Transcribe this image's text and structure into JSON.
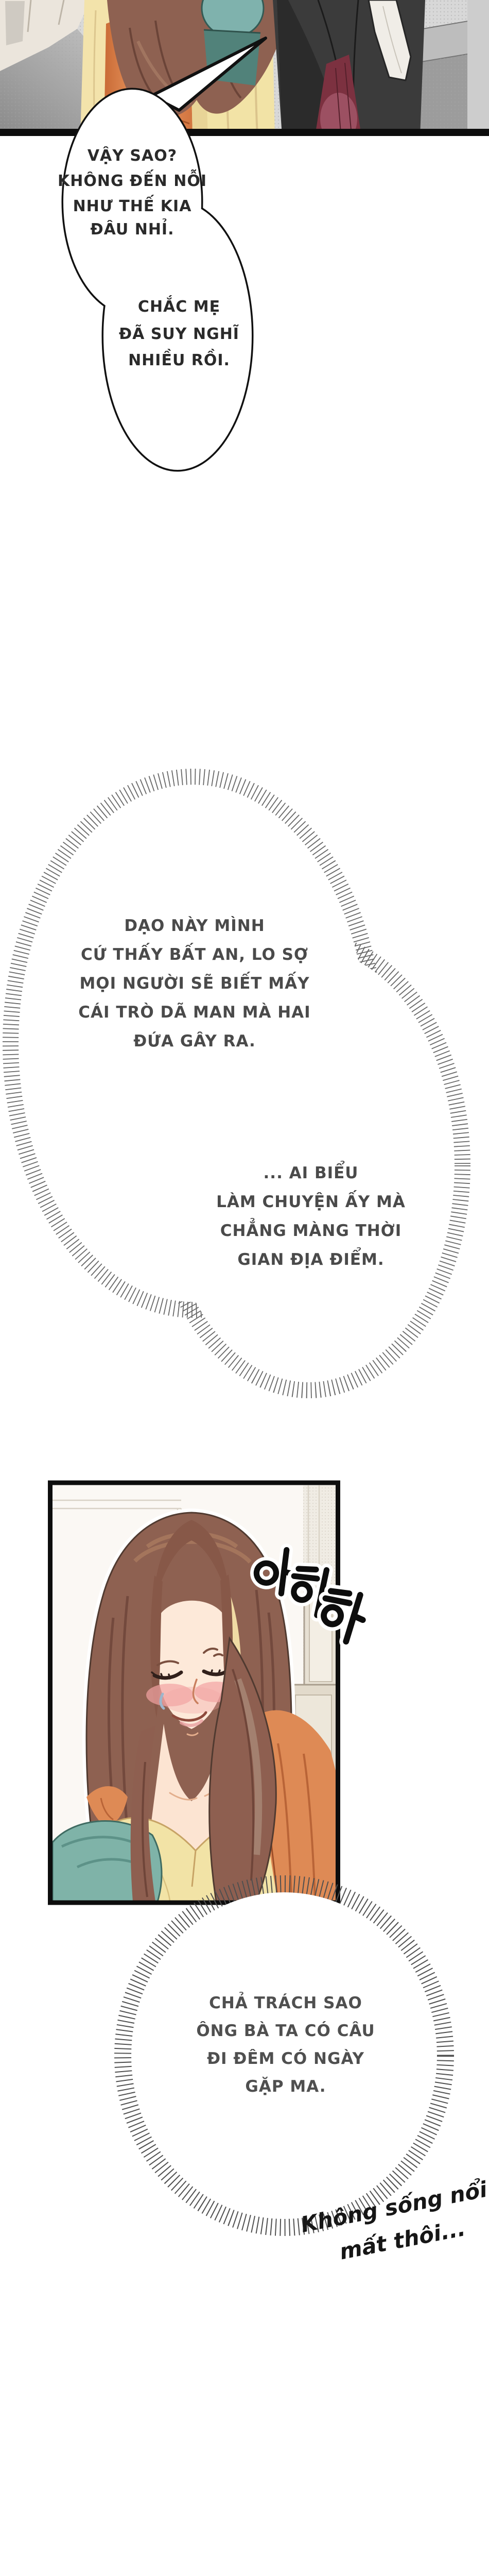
{
  "page": {
    "type": "webtoon-episode-page",
    "background": "#FFFFFF"
  },
  "speech_bubble": {
    "part_a_lines": [
      "VẬY SAO?",
      "KHÔNG ĐẾN NỖI",
      "NHƯ THẾ KIA",
      "ĐÂU NHỈ."
    ],
    "part_b_lines": [
      "CHẮC MẸ",
      "ĐÃ SUY NGHĨ",
      "NHIỀU RỒI."
    ]
  },
  "thought_bubble_1": {
    "lines": [
      "DẠO NÀY MÌNH",
      "CỨ THẤY BẤT AN, LO SỢ",
      "MỌI NGƯỜI SẼ BIẾT MẤY",
      "CÁI TRÒ DÃ MAN MÀ HAI",
      "ĐỨA GÂY RA."
    ]
  },
  "thought_bubble_2": {
    "lines": [
      "... AI BIỂU",
      "LÀM CHUYỆN ẤY MÀ",
      "CHẲNG MÀNG THỜI",
      "GIAN ĐỊA ĐIỂM."
    ]
  },
  "thought_bubble_3": {
    "lines": [
      "CHẢ TRÁCH SAO",
      "ÔNG BÀ TA CÓ CÂU",
      "ĐI ĐÊM CÓ NGÀY",
      "GẶP MA."
    ]
  },
  "handwritten_note": {
    "lines": [
      "Không sống nổi",
      "mất thôi..."
    ]
  },
  "panel_sfx": {
    "text": "아하하"
  },
  "colors": {
    "page_bg": "#FFFFFF",
    "panel_border": "#0D0D0D",
    "wall_gray": "#D8D8D8",
    "door_cream": "#EBE5DC",
    "hair_brown": "#8E6151",
    "hair_shadow": "#6F4539",
    "skin": "#FDE9D9",
    "blush_pink": "#F2A3A3",
    "dress_orange": "#DE8A55",
    "coat_yellow": "#F2E3A6",
    "pillow_teal": "#7FB3A8",
    "suit_dark": "#3B3B3B",
    "scarf_white": "#F0EDE7",
    "skirt_burgundy": "#7C3140",
    "speech_text": "#2A2A2A",
    "thought_text": "#4A4A4A",
    "hatch_gray": "#666666"
  }
}
